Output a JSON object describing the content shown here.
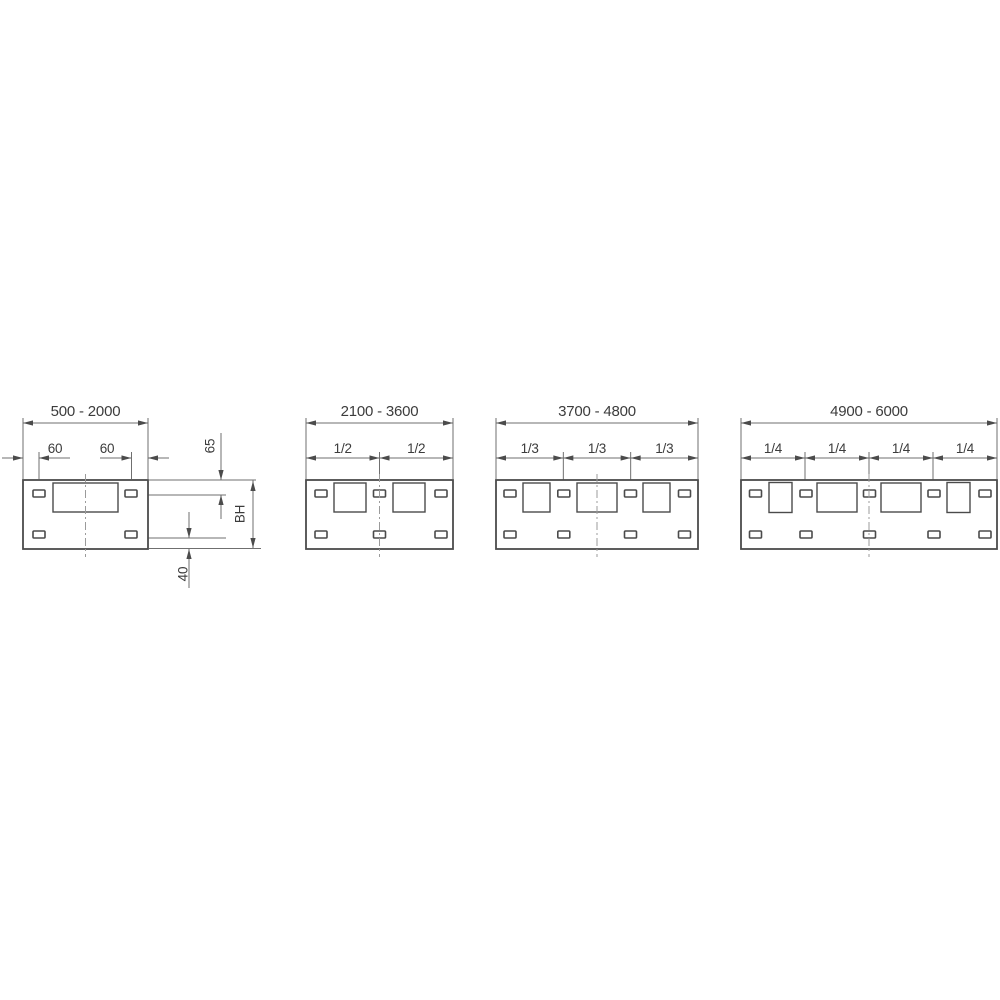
{
  "figure_type": "technical-dimension-drawing",
  "colors": {
    "background": "#ffffff",
    "plate_stroke": "#4b4b4b",
    "module_stroke": "#4b4b4b",
    "dim_line": "#6f6f6f",
    "arrow": "#4b4b4b",
    "text": "#3c3c3c",
    "centerline": "#9b9b9b"
  },
  "common": {
    "plate_y": 480,
    "plate_h": 69,
    "slot_w": 12,
    "slot_h": 7,
    "slot_top_y": 490,
    "slot_bottom_y": 531,
    "top_dim_y": 423,
    "sub_dim_y": 458,
    "ext_top_y": 418,
    "ext_sub_y": 452,
    "ext_sub_bottom": 490,
    "range_label_y": 416,
    "sub_label_y": 453,
    "centerline_y1": 474,
    "centerline_y2": 557,
    "range_font_size": 15,
    "sub_font_size": 13.5
  },
  "diagrams": [
    {
      "name": "panel-500-2000",
      "range_label": "500 - 2000",
      "plate_x1": 23,
      "plate_x2": 148,
      "modules": [
        {
          "x": 53,
          "y": 483,
          "w": 65,
          "h": 29
        }
      ],
      "slots_x": [
        33,
        125
      ],
      "fractions": [],
      "extra": {
        "lines": [
          [
            2,
            458,
            23,
            458
          ],
          [
            39,
            458,
            70,
            458
          ],
          [
            100,
            458,
            131.5,
            458
          ],
          [
            148,
            458,
            169,
            458
          ],
          [
            39,
            452,
            39,
            479
          ],
          [
            131.5,
            452,
            131.5,
            479
          ],
          [
            149,
            480,
            256,
            480
          ],
          [
            138,
            495,
            226,
            495
          ],
          [
            138,
            538,
            226,
            538
          ],
          [
            149,
            548.5,
            261,
            548.5
          ],
          [
            221,
            433,
            221,
            479.5
          ],
          [
            221,
            495.5,
            221,
            519
          ],
          [
            253,
            480.5,
            253,
            548
          ],
          [
            189,
            512,
            189,
            537.5
          ],
          [
            189,
            549,
            189,
            588
          ]
        ],
        "arrows": [
          [
            23,
            458,
            "right"
          ],
          [
            39,
            458,
            "left"
          ],
          [
            131.5,
            458,
            "right"
          ],
          [
            148,
            458,
            "left"
          ],
          [
            221,
            480,
            "down"
          ],
          [
            221,
            495,
            "up"
          ],
          [
            253,
            481,
            "up"
          ],
          [
            253,
            548,
            "down"
          ],
          [
            189,
            538,
            "down"
          ],
          [
            189,
            549,
            "up"
          ]
        ],
        "labels": [
          {
            "text": "60",
            "x": 55,
            "y": 453,
            "rot": 0
          },
          {
            "text": "60",
            "x": 107,
            "y": 453,
            "rot": 0
          },
          {
            "text": "65",
            "x": 210,
            "y": 446,
            "rot": -90
          },
          {
            "text": "BH",
            "x": 240,
            "y": 514,
            "rot": -90
          },
          {
            "text": "40",
            "x": 183,
            "y": 574,
            "rot": -90
          }
        ]
      }
    },
    {
      "name": "panel-2100-3600",
      "range_label": "2100 - 3600",
      "plate_x1": 306,
      "plate_x2": 453,
      "modules": [
        {
          "x": 334,
          "y": 483,
          "w": 32,
          "h": 29
        },
        {
          "x": 393,
          "y": 483,
          "w": 32,
          "h": 29
        }
      ],
      "slots_x": [
        315,
        373.5,
        435
      ],
      "fractions": [
        "1/2",
        "1/2"
      ]
    },
    {
      "name": "panel-3700-4800",
      "range_label": "3700 - 4800",
      "plate_x1": 496,
      "plate_x2": 698,
      "modules": [
        {
          "x": 523,
          "y": 483,
          "w": 27,
          "h": 29
        },
        {
          "x": 577,
          "y": 483,
          "w": 40,
          "h": 29
        },
        {
          "x": 643,
          "y": 483,
          "w": 27,
          "h": 29
        }
      ],
      "slots_x": [
        504,
        557.8,
        624.5,
        678.5
      ],
      "fractions": [
        "1/3",
        "1/3",
        "1/3"
      ]
    },
    {
      "name": "panel-4900-6000",
      "range_label": "4900 - 6000",
      "plate_x1": 741,
      "plate_x2": 997,
      "modules": [
        {
          "x": 769,
          "y": 482.5,
          "w": 23,
          "h": 30
        },
        {
          "x": 817,
          "y": 483,
          "w": 40,
          "h": 29
        },
        {
          "x": 881,
          "y": 483,
          "w": 40,
          "h": 29
        },
        {
          "x": 947,
          "y": 482.5,
          "w": 23,
          "h": 30
        }
      ],
      "slots_x": [
        749.5,
        800,
        863.5,
        928,
        979
      ],
      "fractions": [
        "1/4",
        "1/4",
        "1/4",
        "1/4"
      ]
    }
  ]
}
